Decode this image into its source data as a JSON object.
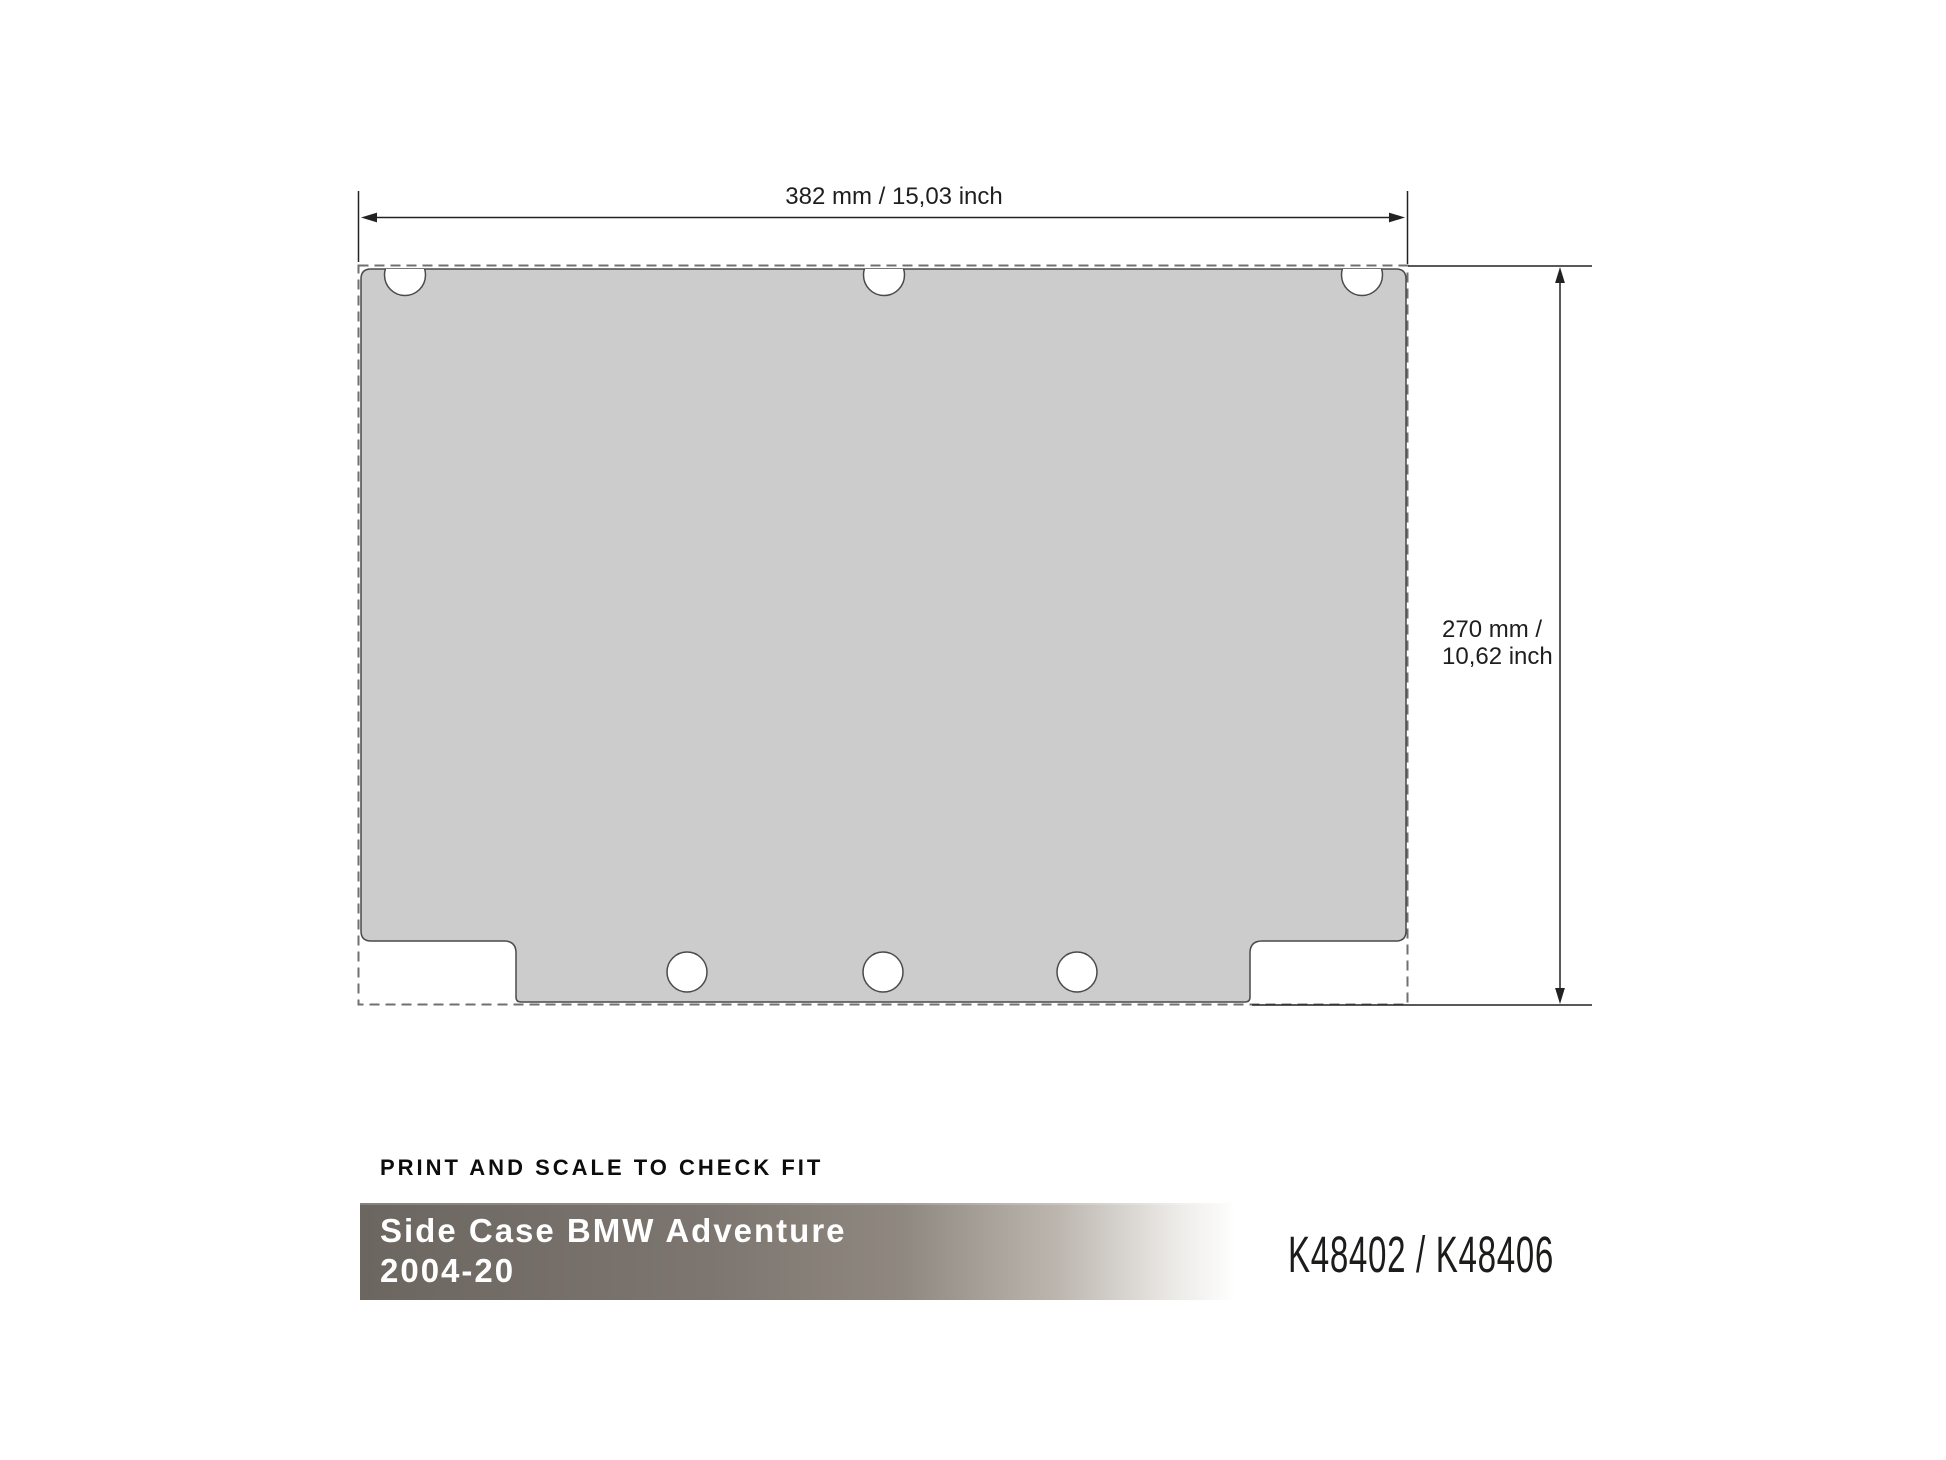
{
  "drawing": {
    "width_label": "382 mm / 15,03 inch",
    "height_label_line1": "270 mm /",
    "height_label_line2": "10,62 inch",
    "shape_fill": "#cccccc",
    "outline_color": "#4a4a4a",
    "dashed_color": "#707070",
    "dimension_color": "#222222"
  },
  "footer": {
    "instruction": "PRINT AND SCALE TO CHECK FIT",
    "banner_line1": "Side Case BMW Adventure",
    "banner_line2": "2004-20",
    "product_codes": "K48402 / K48406",
    "banner_color_start": "#6c6660",
    "banner_color_end": "#ffffff",
    "banner_text_color": "#ffffff"
  }
}
